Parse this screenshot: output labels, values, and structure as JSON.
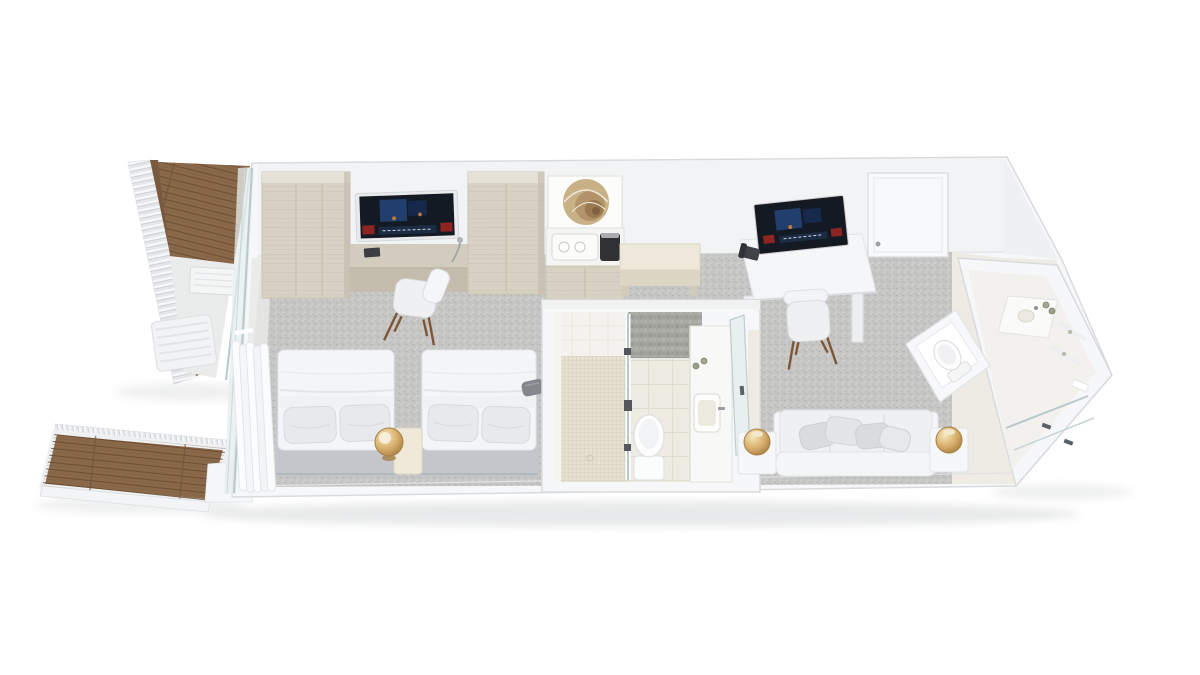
{
  "scene": {
    "type": "3d-floor-plan-render",
    "subject": "hotel suite with twin beds, living area, two bathrooms and two balconies",
    "view": "isometric top-down cutaway",
    "background": "#ffffff"
  },
  "palette": {
    "wall": "#f6f7f8",
    "wallFace": "#f1f3f4",
    "wallStroke": "#d8dbdd",
    "carpet": "#c6c7c5",
    "floorWhite": "#e9eae8",
    "entryFloor": "#edebe4",
    "wood": "#8a684a",
    "travertine": "#d8d2c5",
    "travertineDark": "#c3bcac",
    "bench": "#eee8da",
    "stone": "#a7a7a2",
    "showerTile": "#e7e1d2",
    "bathFloor": "#edebe2",
    "glass": "#b9c8ca",
    "glassFill": "#e6eeee",
    "gold": "#d2a96d",
    "goldDeep": "#a87f45",
    "bedWhite": "#f4f5f7",
    "pillow": "#e7eaed",
    "bedBase": "#c3c7cc",
    "sofa": "#eef0f2",
    "pillowGray": "#d9dcdf",
    "tvDark": "#141a23",
    "tvBlue": "#24457a",
    "tvRed": "#8e2421",
    "chairLeg": "#7d5637",
    "art": "#c8b186",
    "shadow": "#9aa0a3"
  },
  "areas": [
    {
      "id": "balcony-upper",
      "label": "Upper balcony",
      "items": [
        "wood deck",
        "louvered privacy screen",
        "glass balustrade",
        "outdoor slat table",
        "ac unit"
      ]
    },
    {
      "id": "balcony-lower",
      "label": "Lower balcony",
      "items": [
        "wood deck",
        "louvered railing",
        "white fascia"
      ]
    },
    {
      "id": "sleeping-area",
      "label": "Sleeping area",
      "items": [
        "twin bed 1",
        "twin bed 2",
        "nightstand",
        "brass dome lamp",
        "luggage stool",
        "wardrobe 1",
        "wardrobe 2",
        "wall tv",
        "work counter",
        "desk chair",
        "sliding glass door",
        "sheer curtain"
      ]
    },
    {
      "id": "kitchenette",
      "label": "Minibar / kitchenette",
      "items": [
        "nautilus artwork",
        "welcome tray with cups",
        "coffee machine",
        "minibar cabinet",
        "console bench"
      ]
    },
    {
      "id": "living-area",
      "label": "Living area",
      "items": [
        "writing desk",
        "desktop tv",
        "telephone",
        "chair",
        "entrance door",
        "sofa with cushions",
        "side table left",
        "side table right",
        "brass lamp left",
        "brass lamp right"
      ]
    },
    {
      "id": "bathroom-center",
      "label": "Central bathroom",
      "items": [
        "walk-in shower",
        "mosaic shower floor",
        "glass partition",
        "stone accent wall",
        "toilet",
        "vanity counter",
        "sink",
        "amenity bottles",
        "glass entry door"
      ]
    },
    {
      "id": "bathroom-right",
      "label": "End bathroom",
      "items": [
        "wc niche with toilet",
        "vanity with sink",
        "amenity bottles",
        "shelves",
        "glass shower",
        "towel"
      ]
    }
  ]
}
